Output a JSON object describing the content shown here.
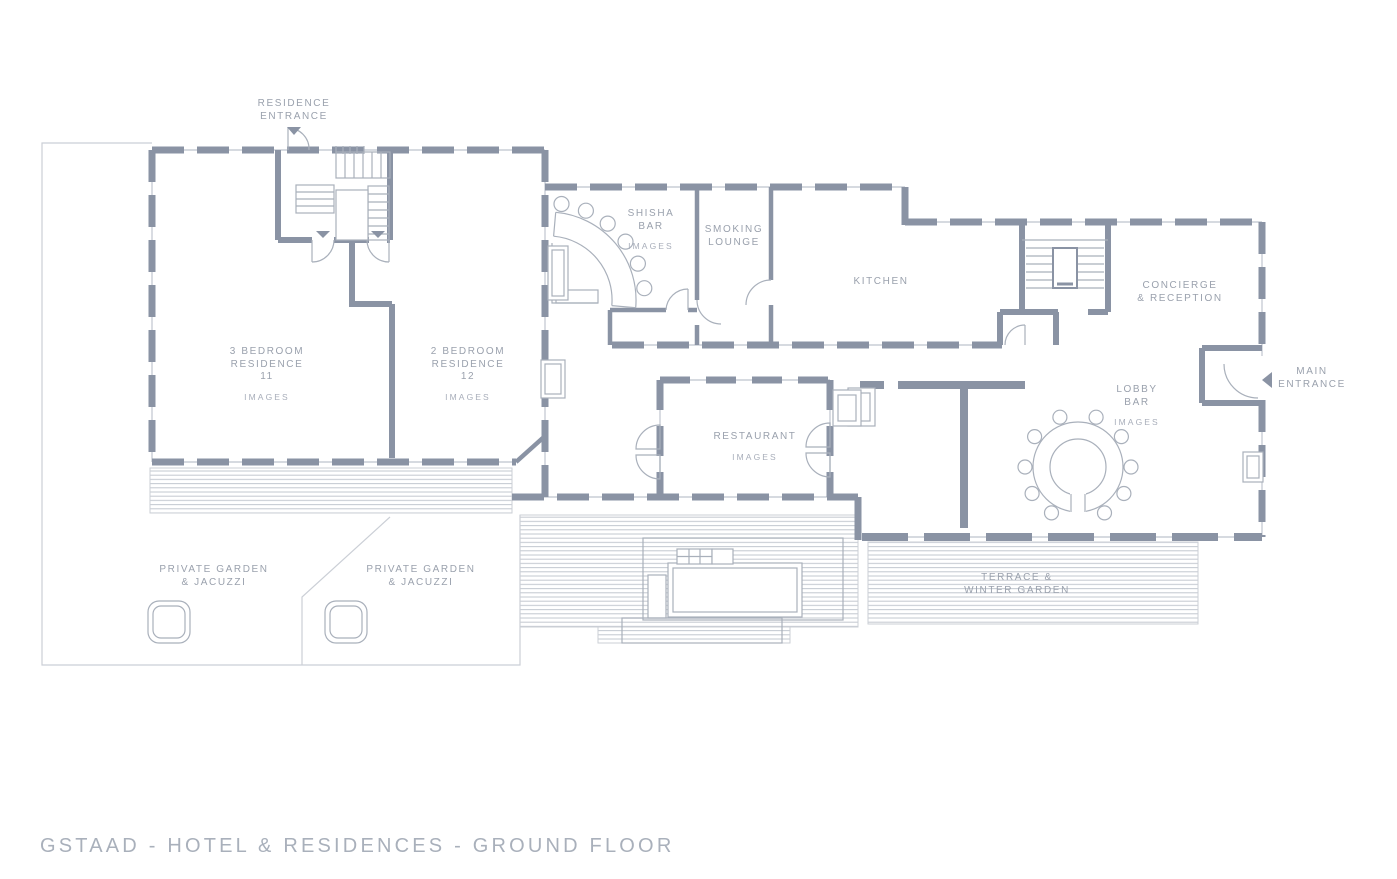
{
  "colors": {
    "background": "#FFFFFF",
    "wall": "#8A93A4",
    "thin_line": "#C9CDD5",
    "hatch_line": "#C2C7CF",
    "label_text": "#9AA1AD",
    "link_text": "#A8AEBA",
    "title_text": "#A9B0BB"
  },
  "labels": {
    "residence_entrance": {
      "lines": [
        "RESIDENCE",
        "ENTRANCE"
      ]
    },
    "shisha_bar": {
      "lines": [
        "SHISHA",
        "BAR"
      ],
      "link": "IMAGES"
    },
    "smoking_lounge": {
      "lines": [
        "SMOKING",
        "LOUNGE"
      ]
    },
    "kitchen": {
      "lines": [
        "KITCHEN"
      ]
    },
    "concierge_reception": {
      "lines": [
        "CONCIERGE",
        "& RECEPTION"
      ]
    },
    "residence_11": {
      "lines": [
        "3 BEDROOM",
        "RESIDENCE",
        "11"
      ],
      "link": "IMAGES"
    },
    "residence_12": {
      "lines": [
        "2 BEDROOM",
        "RESIDENCE",
        "12"
      ],
      "link": "IMAGES"
    },
    "lobby_bar": {
      "lines": [
        "LOBBY",
        "BAR"
      ],
      "link": "IMAGES"
    },
    "main_entrance": {
      "lines": [
        "MAIN",
        "ENTRANCE"
      ]
    },
    "restaurant": {
      "lines": [
        "RESTAURANT"
      ],
      "link": "IMAGES"
    },
    "private_garden_west": {
      "lines": [
        "PRIVATE GARDEN",
        "& JACUZZI"
      ]
    },
    "private_garden_east": {
      "lines": [
        "PRIVATE GARDEN",
        "& JACUZZI"
      ]
    },
    "terrace_winter_garden": {
      "lines": [
        "TERRACE &",
        "WINTER GARDEN"
      ]
    }
  },
  "footer": {
    "title": "GSTAAD - HOTEL & RESIDENCES - GROUND FLOOR"
  }
}
